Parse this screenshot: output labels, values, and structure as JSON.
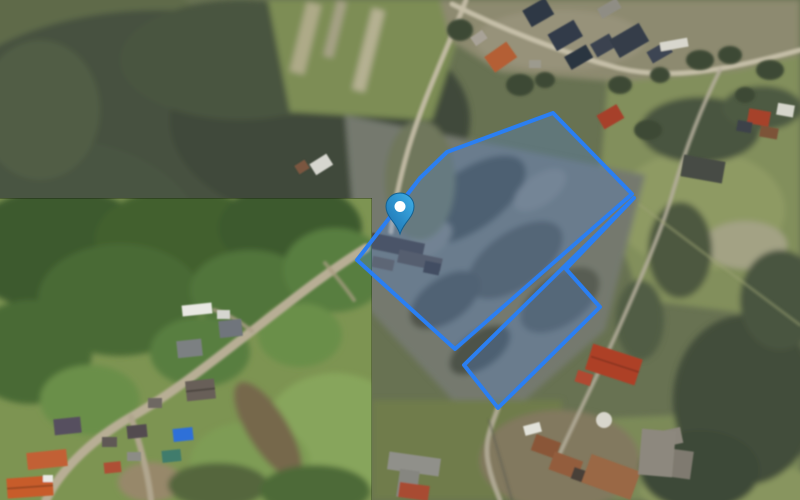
{
  "app": {
    "name": "satellite-parcel-map"
  },
  "map": {
    "type": "satellite-imagery",
    "overlay": {
      "accent_color": "#2b7ff2",
      "fill_color": "#4f86e0",
      "fill_opacity": "0.28",
      "stroke_width": "4",
      "parcels": {
        "upper": {
          "points": "553,113 632,194 455,349 357,260 420,178 447,152"
        },
        "lower": {
          "points": "464,365 634,198 566,269 600,307 498,408"
        }
      }
    },
    "marker": {
      "transform": "translate(400,234)",
      "color_light": "#3fb0e8",
      "color_dark": "#1a6fae",
      "outline_color": "#15608f",
      "dot_color": "#ffffff"
    },
    "inset": {
      "x": "0",
      "y": "198",
      "width": "372",
      "height": "302"
    }
  }
}
